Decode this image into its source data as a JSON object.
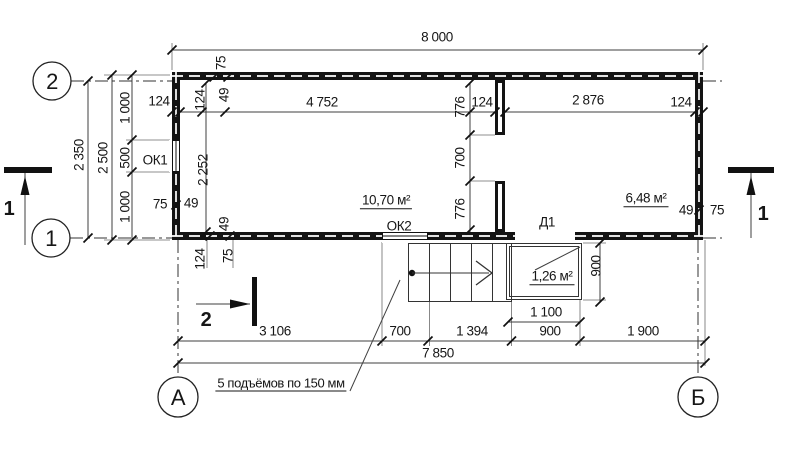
{
  "drawing": {
    "axes": {
      "top_left": "2",
      "bottom_left": "1",
      "col_left": "А",
      "col_right": "Б"
    },
    "sections": {
      "one": "1",
      "two": "2"
    },
    "dims": {
      "top": {
        "overall": "8 000",
        "w124_left": "124",
        "room1": "4 752",
        "part124": "124",
        "room2": "2 876",
        "w124_right": "124",
        "v75": "75",
        "v49": "49",
        "v124": "124"
      },
      "left": {
        "d2350": "2 350",
        "d2500": "2 500",
        "d1000a": "1 000",
        "d500": "500",
        "d1000b": "1 000"
      },
      "inner": {
        "d2252": "2 252",
        "p776t": "776",
        "p700": "700",
        "p776b": "776"
      },
      "corner_bl": {
        "h75": "75",
        "h49": "49",
        "v49": "49",
        "v124": "124",
        "v75": "75"
      },
      "corner_br": {
        "h49": "49",
        "h75": "75"
      },
      "bottom": {
        "d3106": "3 106",
        "d700": "700",
        "d1394": "1 394",
        "d900": "900",
        "d1900": "1 900",
        "d7850": "7 850",
        "p1100": "1 100",
        "p900": "900"
      }
    },
    "labels": {
      "ok1": "ОК1",
      "ok2": "ОК2",
      "d1": "Д1",
      "room1_area": "10,70 м²",
      "room2_area": "6,48 м²",
      "porch_area": "1,26 м²",
      "note": "5 подъёмов по 150 мм"
    },
    "colors": {
      "line": "#161616",
      "background": "#ffffff"
    }
  }
}
